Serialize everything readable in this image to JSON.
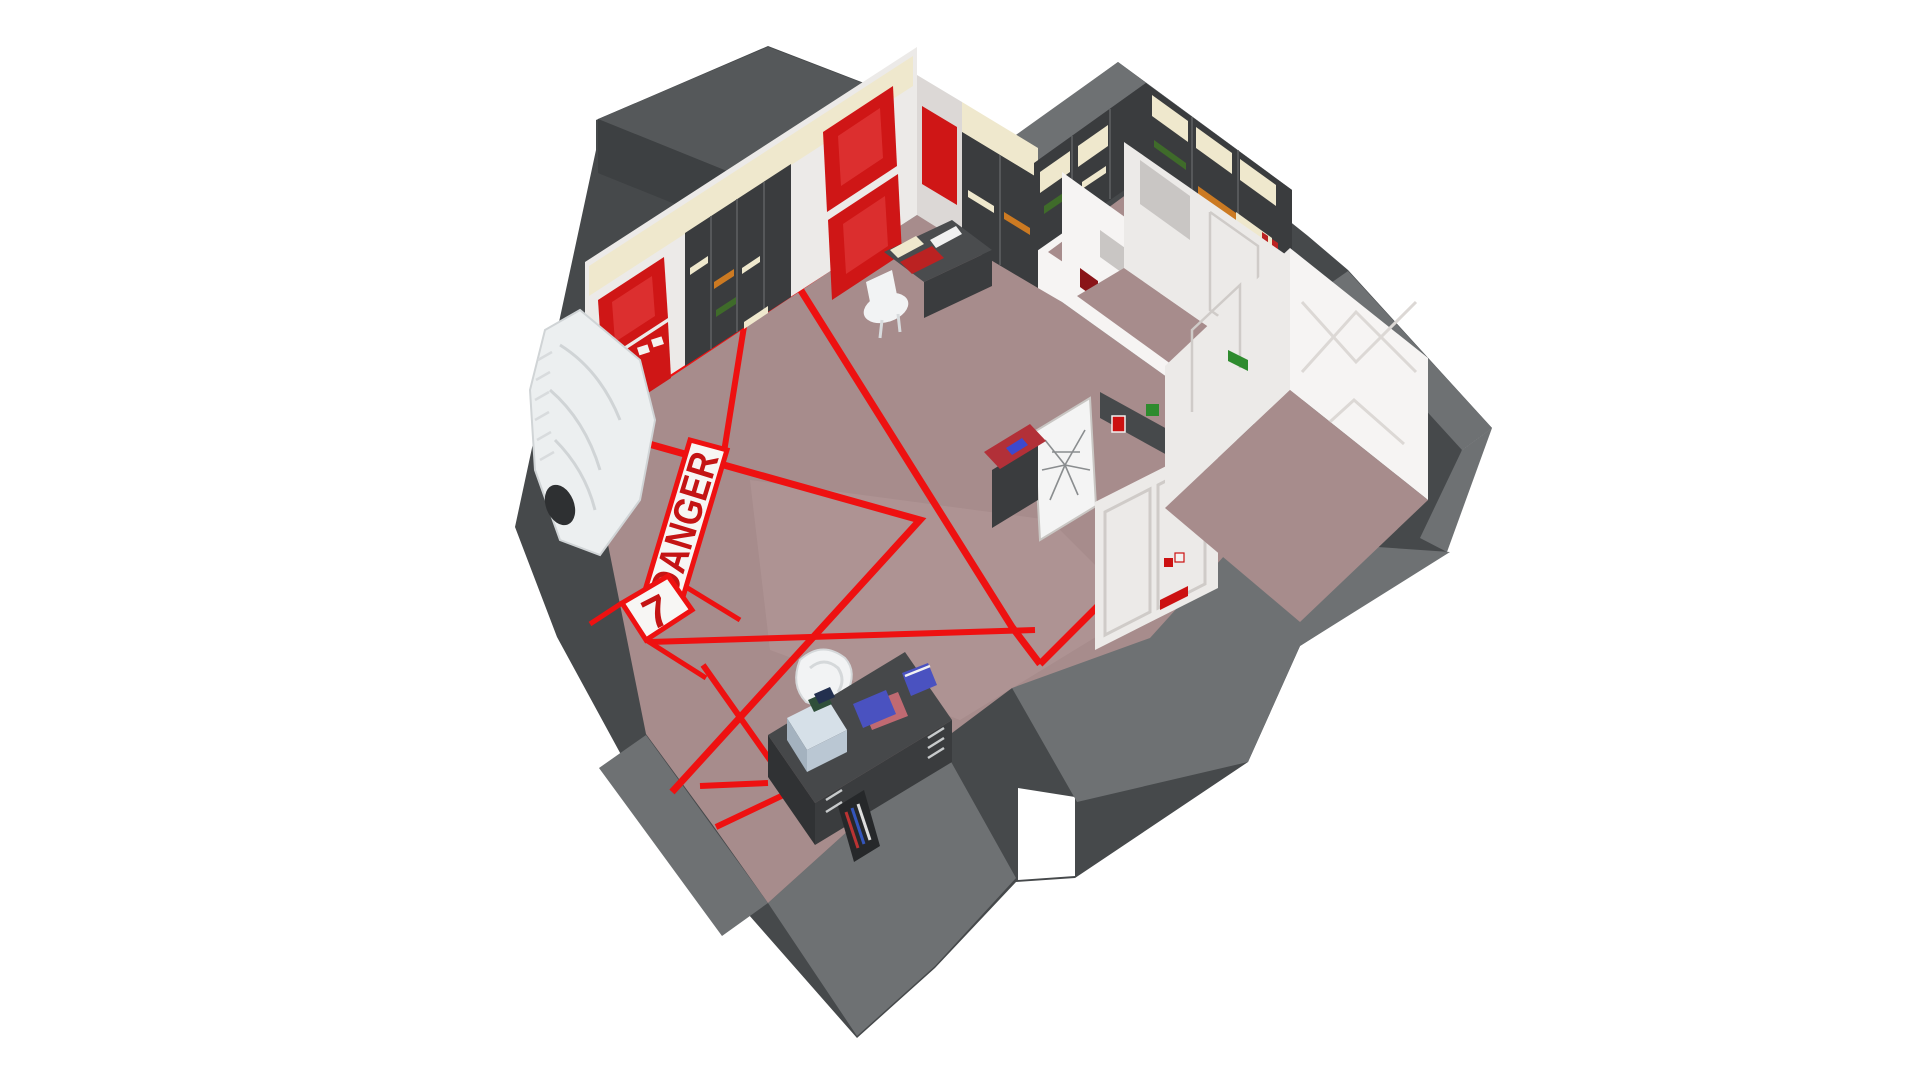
{
  "scene": {
    "description": "Isometric 3D cutaway of an underground launch control room facility",
    "floor_markings": {
      "danger_label": "DANGER",
      "zone_number": "7"
    },
    "colors": {
      "background": "#ffffff",
      "floor": "#a78c8c",
      "floor_light": "#bfa5a5",
      "wall_side": "#46494b",
      "wall_top": "#6e7173",
      "wall_dark": "#3d4042",
      "roof_top": "#55585a",
      "interior_wall": "#eceae8",
      "interior_wall_lit": "#f6f4f3",
      "interior_wall_shade": "#dcd8d6",
      "red_line": "#ee1111",
      "red_panel": "#cf1616",
      "red_panel_glow": "#e84545",
      "stripe_white": "#f7f6f4",
      "danger_red": "#c41414",
      "cream_light": "#efe8cd",
      "rack_body": "#3a3c3e",
      "rack_frame": "#5d6062",
      "console_body": "#4a4c4e",
      "console_front": "#3a3c3e",
      "console_red_top": "#b23038",
      "desk_body": "#46484a",
      "chair_white": "#f2f3f4",
      "folder_blue": "#4a52c0",
      "folder_pink": "#c06a72",
      "box_blue": "#bac7d3",
      "module_green": "#3f6b2a",
      "module_orange": "#cc7a22",
      "module_red": "#bb2222",
      "module_cyan": "#4d9dbb",
      "sign_green": "#2e8b2e",
      "button_red": "#cc1111",
      "whiteboard": "#f4f4f4",
      "window_glass": "#c9c6c4"
    },
    "objects": [
      "equipment-rack-walls",
      "control-consoles",
      "office-desk-with-folders",
      "white-chairs",
      "whiteboard-with-schematic",
      "blast-doors",
      "ventilation-unit",
      "wall-bookshelf",
      "danger-floor-stripe",
      "zone-7-floor-tile",
      "red-hazard-floor-lines",
      "empty-side-room"
    ]
  }
}
